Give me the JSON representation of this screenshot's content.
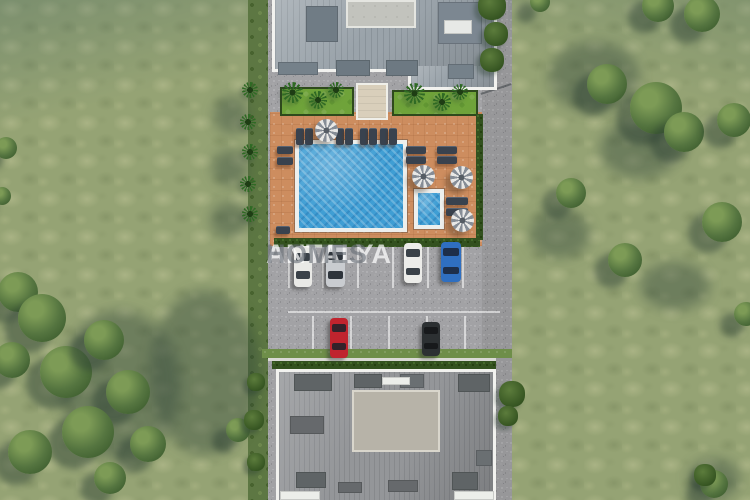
{
  "watermark": {
    "part1": "ANTALYA",
    "part2": "HOMES"
  },
  "palette": {
    "grass": "#95a374",
    "gravel": "#a2a2a5",
    "deck": "#cd8d5f",
    "pool_water": "#3f9ed4",
    "pool_coping": "#edefed",
    "roof_top_building": "#9aa3aa",
    "roof_bottom_building": "#949699",
    "flat_roof_top": "#c2c3bd",
    "flat_roof_bottom": "#b7b3a8",
    "hedge": "#33511f",
    "garden_grass": "#6fa33a",
    "car_white": "#e9e9e6",
    "car_silver": "#c9ccd0",
    "car_blue": "#2f6fc1",
    "car_red": "#c0242e",
    "car_black": "#2c3032",
    "watermark_white": "rgba(255,255,255,0.72)",
    "watermark_gray": "rgba(104,110,118,0.62)"
  },
  "scene": {
    "cars": [
      {
        "name": "white-sedan-1",
        "x": 294,
        "y": 246,
        "w": 18,
        "h": 41,
        "body": "#e9e9e6",
        "glass": "#3a4148"
      },
      {
        "name": "silver-sedan",
        "x": 326,
        "y": 245,
        "w": 19,
        "h": 42,
        "body": "#c9ccd0",
        "glass": "#2e343b"
      },
      {
        "name": "white-sedan-2",
        "x": 404,
        "y": 243,
        "w": 18,
        "h": 40,
        "body": "#ecece9",
        "glass": "#3a4148"
      },
      {
        "name": "blue-sedan",
        "x": 441,
        "y": 242,
        "w": 20,
        "h": 40,
        "body": "#2f6fc1",
        "glass": "#1d2e4a"
      },
      {
        "name": "red-sedan",
        "x": 330,
        "y": 318,
        "w": 18,
        "h": 40,
        "body": "#c0242e",
        "glass": "#33222a"
      },
      {
        "name": "black-suv",
        "x": 422,
        "y": 322,
        "w": 18,
        "h": 34,
        "body": "#2c3032",
        "glass": "#17191b"
      }
    ],
    "umbrellas": [
      {
        "x": 315,
        "y": 119,
        "s": 23
      },
      {
        "x": 412,
        "y": 165,
        "s": 23
      },
      {
        "x": 450,
        "y": 166,
        "s": 23
      },
      {
        "x": 451,
        "y": 209,
        "s": 23
      }
    ],
    "loungers": [
      {
        "x": 296,
        "y": 128,
        "w": 8,
        "h": 17
      },
      {
        "x": 305,
        "y": 128,
        "w": 8,
        "h": 17
      },
      {
        "x": 336,
        "y": 128,
        "w": 8,
        "h": 17
      },
      {
        "x": 345,
        "y": 128,
        "w": 8,
        "h": 17
      },
      {
        "x": 360,
        "y": 128,
        "w": 8,
        "h": 17
      },
      {
        "x": 369,
        "y": 128,
        "w": 8,
        "h": 17
      },
      {
        "x": 380,
        "y": 128,
        "w": 8,
        "h": 17
      },
      {
        "x": 389,
        "y": 128,
        "w": 8,
        "h": 17
      },
      {
        "x": 277,
        "y": 146,
        "w": 16,
        "h": 8
      },
      {
        "x": 277,
        "y": 157,
        "w": 16,
        "h": 8
      },
      {
        "x": 406,
        "y": 146,
        "w": 20,
        "h": 8
      },
      {
        "x": 406,
        "y": 156,
        "w": 20,
        "h": 8
      },
      {
        "x": 437,
        "y": 146,
        "w": 20,
        "h": 8
      },
      {
        "x": 437,
        "y": 156,
        "w": 20,
        "h": 8
      },
      {
        "x": 446,
        "y": 197,
        "w": 22,
        "h": 8
      },
      {
        "x": 446,
        "y": 208,
        "w": 22,
        "h": 8
      },
      {
        "x": 276,
        "y": 226,
        "w": 14,
        "h": 8
      }
    ],
    "pool": {
      "x": 295,
      "y": 140,
      "w": 112,
      "h": 92
    },
    "kids_pool": {
      "x": 414,
      "y": 189,
      "w": 30,
      "h": 40
    },
    "garden": {
      "gravel_band": {
        "x": 272,
        "y": 70,
        "w": 210,
        "h": 48
      },
      "grass_left": {
        "x": 280,
        "y": 87,
        "w": 74,
        "h": 29
      },
      "grass_right": {
        "x": 392,
        "y": 90,
        "w": 86,
        "h": 26
      },
      "path": {
        "x": 356,
        "y": 83,
        "w": 32,
        "h": 37
      }
    },
    "hedges": [
      {
        "x": 274,
        "y": 238,
        "w": 206,
        "h": 9
      },
      {
        "x": 476,
        "y": 114,
        "w": 7,
        "h": 126
      },
      {
        "x": 272,
        "y": 361,
        "w": 224,
        "h": 8
      }
    ],
    "curbs": [
      {
        "x": 268,
        "y": 358,
        "w": 228,
        "h": 3
      }
    ],
    "grass_strips": [
      {
        "x": 262,
        "y": 349,
        "w": 250,
        "h": 9
      }
    ],
    "parking_lines": {
      "vertical_top": {
        "xs": [
          288,
          322,
          357,
          392,
          427,
          462
        ],
        "y": 246,
        "h": 42
      },
      "vertical_bottom": {
        "xs": [
          312,
          350,
          388,
          426,
          464
        ],
        "y": 316,
        "h": 40
      },
      "horizontal": {
        "x": 288,
        "y": 311,
        "w": 212,
        "h": 2
      }
    },
    "roof_top": {
      "flat": {
        "x": 346,
        "y": 0,
        "w": 70,
        "h": 28
      },
      "dormers": [
        {
          "x": 306,
          "y": 6,
          "w": 32,
          "h": 36,
          "c": "#707c85"
        },
        {
          "x": 438,
          "y": 2,
          "w": 44,
          "h": 42,
          "c": "#7c8791"
        },
        {
          "x": 444,
          "y": 20,
          "w": 28,
          "h": 14,
          "c": "#e7e9e6"
        },
        {
          "x": 336,
          "y": 60,
          "w": 34,
          "h": 16,
          "c": "#6d7982"
        },
        {
          "x": 386,
          "y": 60,
          "w": 32,
          "h": 16,
          "c": "#6d7982"
        },
        {
          "x": 278,
          "y": 62,
          "w": 40,
          "h": 13,
          "c": "#75818a"
        },
        {
          "x": 448,
          "y": 64,
          "w": 26,
          "h": 15,
          "c": "#75818a"
        }
      ]
    },
    "roof_bottom": {
      "flat": {
        "x": 352,
        "y": 390,
        "w": 88,
        "h": 62
      },
      "dormers": [
        {
          "x": 294,
          "y": 374,
          "w": 38,
          "h": 17,
          "c": "#5f6466"
        },
        {
          "x": 354,
          "y": 374,
          "w": 28,
          "h": 14,
          "c": "#5f6466"
        },
        {
          "x": 400,
          "y": 374,
          "w": 24,
          "h": 14,
          "c": "#6a6f72"
        },
        {
          "x": 458,
          "y": 374,
          "w": 32,
          "h": 18,
          "c": "#5f6466"
        },
        {
          "x": 382,
          "y": 377,
          "w": 28,
          "h": 8,
          "c": "#eceeea"
        },
        {
          "x": 290,
          "y": 416,
          "w": 34,
          "h": 18,
          "c": "#66696c"
        },
        {
          "x": 296,
          "y": 472,
          "w": 30,
          "h": 16,
          "c": "#5f6466"
        },
        {
          "x": 338,
          "y": 482,
          "w": 24,
          "h": 11,
          "c": "#66696c"
        },
        {
          "x": 388,
          "y": 480,
          "w": 30,
          "h": 12,
          "c": "#66696c"
        },
        {
          "x": 452,
          "y": 472,
          "w": 26,
          "h": 18,
          "c": "#5f6466"
        },
        {
          "x": 476,
          "y": 450,
          "w": 16,
          "h": 16,
          "c": "#6a6f72"
        },
        {
          "x": 280,
          "y": 491,
          "w": 40,
          "h": 9,
          "c": "#eceeea"
        },
        {
          "x": 454,
          "y": 491,
          "w": 40,
          "h": 9,
          "c": "#eceeea"
        }
      ]
    },
    "trees": [
      {
        "x": 18,
        "y": 292,
        "r": 20
      },
      {
        "x": 42,
        "y": 318,
        "r": 24
      },
      {
        "x": 12,
        "y": 360,
        "r": 18
      },
      {
        "x": 66,
        "y": 372,
        "r": 26
      },
      {
        "x": 104,
        "y": 340,
        "r": 20
      },
      {
        "x": 128,
        "y": 392,
        "r": 22
      },
      {
        "x": 88,
        "y": 432,
        "r": 26
      },
      {
        "x": 30,
        "y": 452,
        "r": 22
      },
      {
        "x": 148,
        "y": 444,
        "r": 18
      },
      {
        "x": 110,
        "y": 478,
        "r": 16
      },
      {
        "x": 238,
        "y": 430,
        "r": 12
      },
      {
        "x": 6,
        "y": 148,
        "r": 11
      },
      {
        "x": 2,
        "y": 196,
        "r": 9
      },
      {
        "x": 658,
        "y": 6,
        "r": 16
      },
      {
        "x": 702,
        "y": 14,
        "r": 18
      },
      {
        "x": 607,
        "y": 84,
        "r": 20
      },
      {
        "x": 656,
        "y": 108,
        "r": 26
      },
      {
        "x": 684,
        "y": 132,
        "r": 20
      },
      {
        "x": 734,
        "y": 120,
        "r": 17
      },
      {
        "x": 571,
        "y": 193,
        "r": 15
      },
      {
        "x": 722,
        "y": 222,
        "r": 20
      },
      {
        "x": 625,
        "y": 260,
        "r": 17
      },
      {
        "x": 746,
        "y": 314,
        "r": 12
      },
      {
        "x": 714,
        "y": 484,
        "r": 14
      },
      {
        "x": 540,
        "y": 2,
        "r": 10
      }
    ],
    "bushes": [
      {
        "x": 492,
        "y": 6,
        "r": 14
      },
      {
        "x": 496,
        "y": 34,
        "r": 12
      },
      {
        "x": 492,
        "y": 60,
        "r": 12
      },
      {
        "x": 512,
        "y": 394,
        "r": 13
      },
      {
        "x": 508,
        "y": 416,
        "r": 10
      },
      {
        "x": 256,
        "y": 382,
        "r": 9
      },
      {
        "x": 254,
        "y": 420,
        "r": 10
      },
      {
        "x": 256,
        "y": 462,
        "r": 9
      },
      {
        "x": 705,
        "y": 475,
        "r": 11
      }
    ],
    "shadow_patches": [
      {
        "x": 150,
        "y": 290,
        "w": 110,
        "h": 165
      },
      {
        "x": 60,
        "y": 310,
        "w": 120,
        "h": 150
      },
      {
        "x": 214,
        "y": 96,
        "w": 34,
        "h": 38
      },
      {
        "x": 212,
        "y": 150,
        "w": 36,
        "h": 36
      },
      {
        "x": 210,
        "y": 202,
        "w": 38,
        "h": 36
      },
      {
        "x": 548,
        "y": 42,
        "w": 92,
        "h": 70
      },
      {
        "x": 600,
        "y": 120,
        "w": 80,
        "h": 58
      },
      {
        "x": 530,
        "y": 210,
        "w": 60,
        "h": 48
      },
      {
        "x": 640,
        "y": 262,
        "w": 70,
        "h": 48
      },
      {
        "x": 688,
        "y": 458,
        "w": 52,
        "h": 42
      }
    ],
    "palms": [
      {
        "x": 250,
        "y": 90,
        "s": 16
      },
      {
        "x": 248,
        "y": 122,
        "s": 16
      },
      {
        "x": 250,
        "y": 152,
        "s": 16
      },
      {
        "x": 248,
        "y": 184,
        "s": 16
      },
      {
        "x": 250,
        "y": 214,
        "s": 16
      },
      {
        "x": 292,
        "y": 92,
        "s": 21
      },
      {
        "x": 318,
        "y": 100,
        "s": 18
      },
      {
        "x": 336,
        "y": 90,
        "s": 16
      },
      {
        "x": 414,
        "y": 93,
        "s": 21
      },
      {
        "x": 442,
        "y": 102,
        "s": 18
      },
      {
        "x": 460,
        "y": 92,
        "s": 16
      }
    ],
    "pole_shadow": {
      "x": 480,
      "y": 88
    }
  }
}
